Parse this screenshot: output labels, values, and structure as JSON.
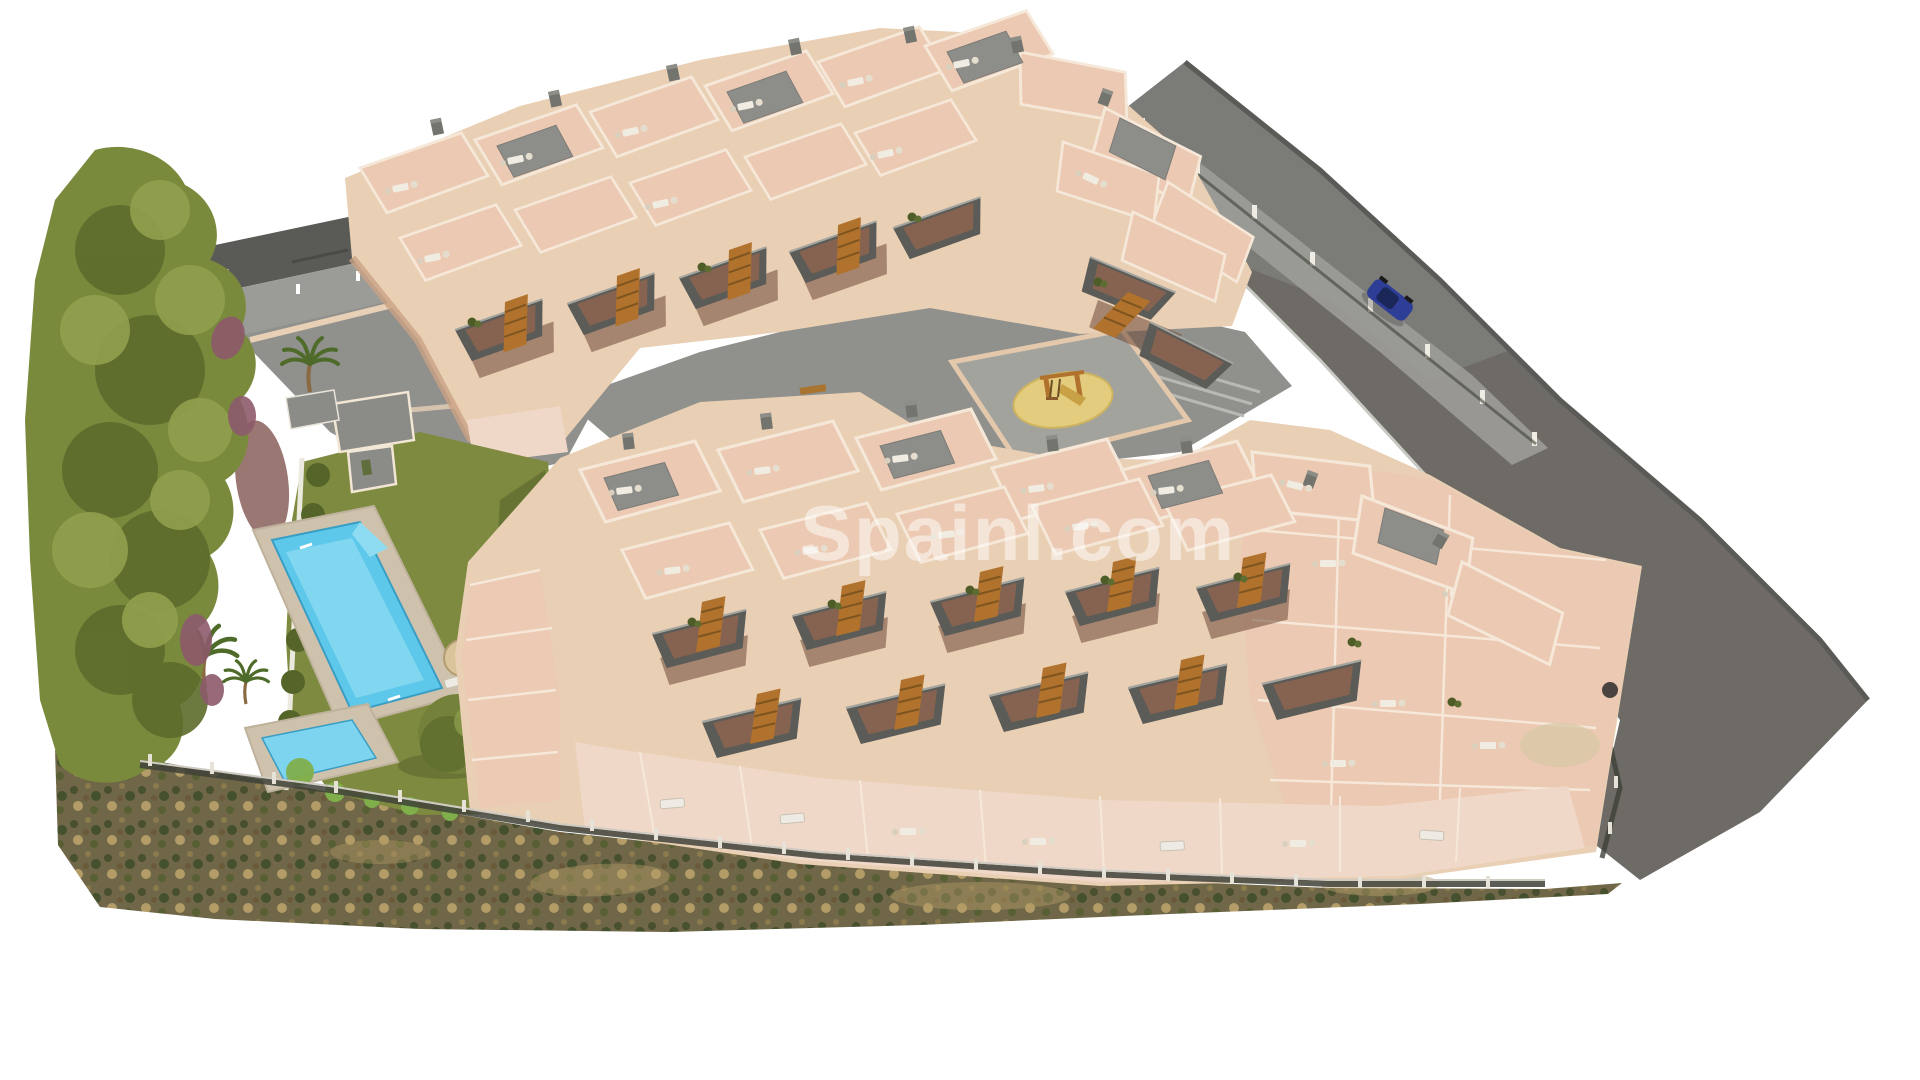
{
  "watermark": {
    "text": "Spainl.com"
  },
  "palette": {
    "background": "#ffffff",
    "road_upper": "#7b7b78",
    "road_lower": "#6e6a66",
    "road_edge": "#5a5a57",
    "paving": "#90908c",
    "paving_light": "#9b9b97",
    "wall_light": "#e9cfb4",
    "wall_shadow": "#c9a184",
    "parapet": "#f6e8d8",
    "roof_tile": "#ecc9b2",
    "roof_tile_light": "#f0d8c8",
    "roof_gray": "#8d8d89",
    "balcony_dark": "#5b5b57",
    "stair_wood": "#b0722c",
    "recess_brown": "#6e4836",
    "tree_green": "#7a8a3d",
    "tree_green_dark": "#5d6c2c",
    "tree_green_light": "#90a04e",
    "shrub_purple": "#8d5a6b",
    "lawn_green": "#7d8a3f",
    "hedge_green": "#55652a",
    "scrub_base": "#6f6747",
    "scrub_dark": "#49502f",
    "scrub_tan": "#b39c67",
    "pool_water": "#5ec8ea",
    "pool_water_light": "#7dd4ee",
    "pool_deck": "#cfc2ad",
    "sand_yellow": "#e3cc7e",
    "parasol_beige": "#d9c49b",
    "car_blue": "#2e3e97",
    "fence_dark": "#3f4238",
    "fence_light": "#e6e2d8",
    "glass_blue": "#cfe0e2",
    "watermark_color": "#ffffff"
  }
}
